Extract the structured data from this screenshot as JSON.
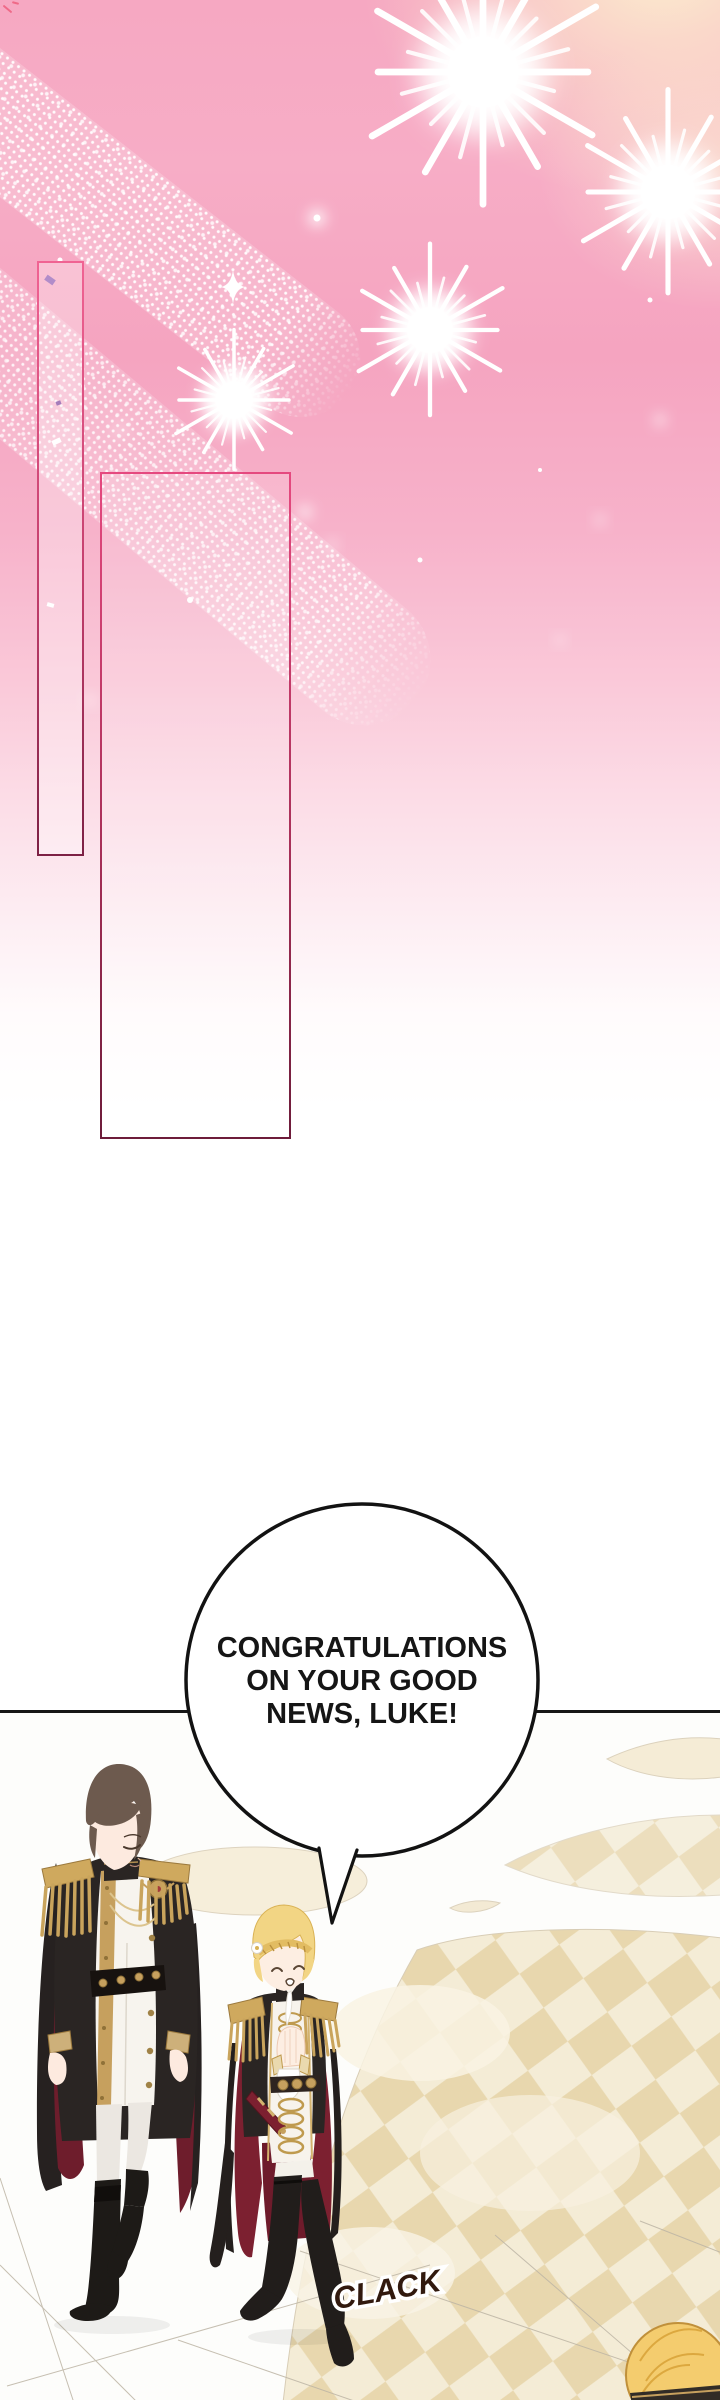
{
  "speech_bubble": {
    "lines": [
      "CONGRATULATIONS",
      "ON YOUR GOOD",
      "NEWS, LUKE!"
    ]
  },
  "sfx": {
    "clack": "CLACK"
  },
  "decor": {
    "icons": [
      "firework-burst-icon",
      "sparkle-diamond-icon",
      "sparkle-trail-icon",
      "confetti-icon"
    ]
  },
  "colors": {
    "sky_pink": "#f7abc4",
    "warm_glow": "#fcf0d2",
    "frame_pink": "#e8538a",
    "frame_maroon": "#6d1c3a",
    "panel_border": "#161616",
    "bubble_outline": "#121212",
    "floor_cream": "#f2e8cf",
    "floor_beige": "#e7d5ab",
    "uniform_black": "#2a2523",
    "gold": "#c6a05e",
    "cape_red": "#6e1d2c",
    "luke_cape_red": "#7c2030",
    "hair_brown": "#6d5a4e",
    "hair_blonde": "#f2d584",
    "sfx_brown": "#31190e"
  }
}
